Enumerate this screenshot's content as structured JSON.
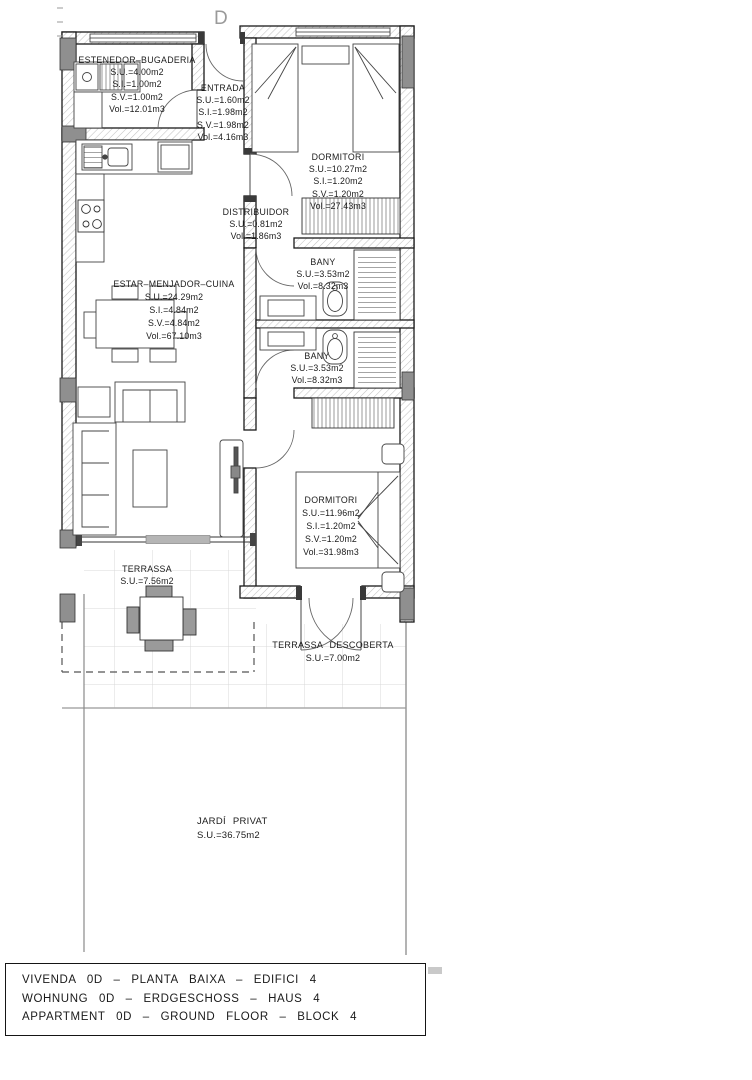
{
  "plan": {
    "section_marker": "D",
    "rooms": {
      "estenedor": {
        "name": "ESTENEDOR–BUGADERIA",
        "metrics": [
          "S.U.=4.00m2",
          "S.I.=1.00m2",
          "S.V.=1.00m2",
          "Vol.=12.01m3"
        ]
      },
      "entrada": {
        "name": "ENTRADA",
        "metrics": [
          "S.U.=1.60m2",
          "S.I.=1.98m2",
          "S.V.=1.98m2",
          "Vol.=4.16m3"
        ]
      },
      "dormitori1": {
        "name": "DORMITORI",
        "metrics": [
          "S.U.=10.27m2",
          "S.I.=1.20m2",
          "S.V.=1.20m2",
          "Vol.=27.43m3"
        ]
      },
      "distribuidor": {
        "name": "DISTRIBUIDOR",
        "metrics": [
          "S.U.=0.81m2",
          "Vol.=1.86m3"
        ]
      },
      "bany1": {
        "name": "BANY",
        "metrics": [
          "S.U.=3.53m2",
          "Vol.=8.32m3"
        ]
      },
      "bany2": {
        "name": "BANY",
        "metrics": [
          "S.U.=3.53m2",
          "Vol.=8.32m3"
        ]
      },
      "estar": {
        "name": "ESTAR–MENJADOR–CUINA",
        "metrics": [
          "S.U.=24.29m2",
          "S.I.=4.84m2",
          "S.V.=4.84m2",
          "Vol.=67.10m3"
        ]
      },
      "dormitori2": {
        "name": "DORMITORI",
        "metrics": [
          "S.U.=11.96m2",
          "S.I.=1.20m2",
          "S.V.=1.20m2",
          "Vol.=31.98m3"
        ]
      },
      "terrassa": {
        "name": "TERRASSA",
        "metrics": [
          "S.U.=7.56m2"
        ]
      },
      "terrassa_descoberta": {
        "name": "TERRASSA DESCOBERTA",
        "metrics": [
          "S.U.=7.00m2"
        ]
      },
      "jardi": {
        "name": "JARDÍ PRIVAT",
        "metrics": [
          "S.U.=36.75m2"
        ]
      }
    }
  },
  "title_block": {
    "lines": [
      "VIVENDA 0D – PLANTA BAIXA – EDIFICI 4",
      "WOHNUNG 0D – ERDGESCHOSS – HAUS 4",
      "APPARTMENT 0D – GROUND FLOOR – BLOCK 4"
    ]
  },
  "colors": {
    "wall_line": "#1a1a1a",
    "wall_hatch": "#c2c2c2",
    "pillar_gray": "#8f8f8f",
    "window_gray": "#b5b5b5",
    "tile_grid": "#d8d8d8",
    "dashed_boundary": "#555555",
    "text": "#1b1b1b",
    "paper": "#ffffff"
  }
}
